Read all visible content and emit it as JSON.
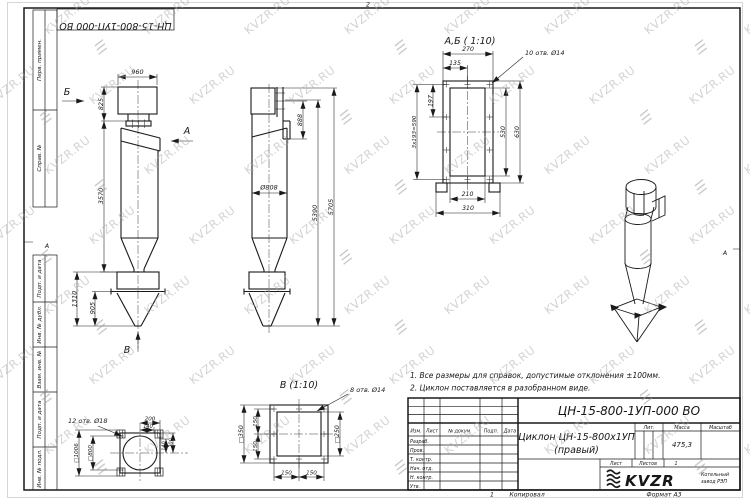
{
  "sheet": {
    "doc_number": "ЦН-15-800-1УП-000 ВО",
    "zone_top": "2",
    "zone_bottom": "1",
    "zone_left": "А",
    "zone_right": "А",
    "copy_num": "1"
  },
  "watermark": {
    "text": "KVZR.RU",
    "logo_glyph": "☰"
  },
  "margin": {
    "cell_top_1": "Перв. примен.",
    "cell_top_2": "Справ. №",
    "cell_bot_1": "Подп. и дата",
    "cell_bot_2": "Инв. № дубл.",
    "cell_bot_3": "Взам. инв. №",
    "cell_bot_4": "Подп. и дата",
    "cell_bot_5": "Инв. № подл."
  },
  "notes": {
    "line1": "1. Все размеры для справок, допустимые отклонения ±100мм.",
    "line2": "2. Циклон поставляется в разобранном виде."
  },
  "front_view": {
    "dim_960": "960",
    "dim_825": "825",
    "dim_3570": "3570",
    "dim_1310": "1310",
    "dim_905": "905",
    "arrow_b": "Б",
    "arrow_a": "А",
    "arrow_v": "В"
  },
  "side_view": {
    "dim_888": "888",
    "dim_d808": "Ø808",
    "dim_5390": "5390",
    "dim_5705": "5705"
  },
  "detail_ab": {
    "title": "А,Б ( 1:10)",
    "holes": "10 отв. Ø14",
    "dim_270": "270",
    "dim_135": "135",
    "dim_197": "197",
    "dim_590": "3х193=590",
    "dim_530": "530",
    "dim_630": "630",
    "dim_210": "210",
    "dim_310": "310"
  },
  "detail_v": {
    "title": "В (1:10)",
    "holes": "8 отв. Ø14",
    "dim_350": "□350",
    "dim_250": "□250",
    "dim_150_l1": "150",
    "dim_150_l2": "150",
    "dim_150_b1": "150",
    "dim_150_b2": "150"
  },
  "flange_view": {
    "holes": "12 отв. Ø18",
    "dim_200_top": "200",
    "dim_140_top": "140",
    "dim_140_r": "140",
    "dim_200_r": "200",
    "dim_1006": "□1006",
    "dim_800": "□800"
  },
  "titleblock": {
    "designation": "ЦН-15-800-1УП-000 ВО",
    "name_line1": "Циклон ЦН-15-800х1УП",
    "name_line2": "(правый)",
    "col_izm": "Изм.",
    "col_list": "Лист",
    "col_doc": "№ докум.",
    "col_podp": "Подп.",
    "col_data": "Дата",
    "row_1": "Разраб.",
    "row_2": "Пров.",
    "row_3": "Т. контр.",
    "row_4": "Нач. отд.",
    "row_5": "Н. контр.",
    "row_6": "Утв.",
    "lit_label": "Лит.",
    "mass_label": "Масса",
    "scale_label": "Масштаб",
    "mass_value": "475,3",
    "scale_value": "1:40",
    "sheet_label": "Лист",
    "sheets_label": "Листов",
    "sheets_value": "1",
    "logo_text": "KVZR",
    "org_line1": "Котельный",
    "org_line2": "завод РЭП",
    "copied": "Копировал",
    "format": "Формат А3"
  }
}
